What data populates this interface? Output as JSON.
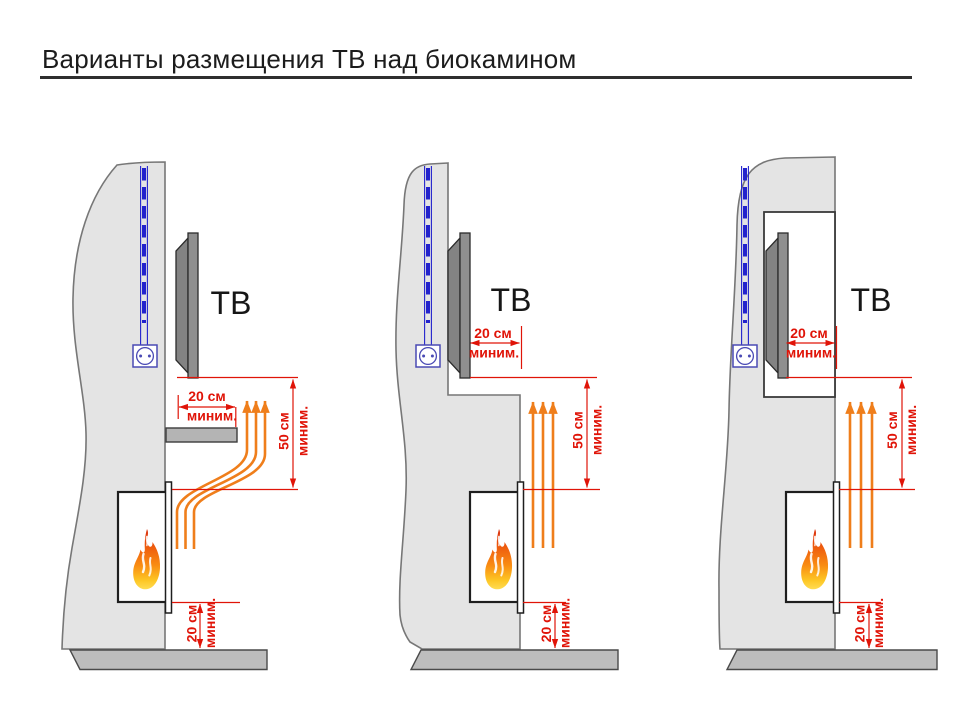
{
  "title": "Варианты размещения ТВ над биокамином",
  "diagram": {
    "tv_label": "ТВ",
    "dim_20cm": "20 см",
    "dim_50cm": "50 см",
    "dim_min_suffix": "миним.",
    "colors": {
      "dimension_red": "#e01408",
      "airflow_orange": "#ef7e1b",
      "cable_blue": "#2222cc",
      "outlet_blue": "#4a4ab4",
      "wall_gray": "#e4e4e4",
      "floor_gray": "#bdbdbd",
      "tv_gray": "#8f8f8f",
      "flame_top": "#d92c0a",
      "flame_bottom": "#ffdc52"
    }
  }
}
